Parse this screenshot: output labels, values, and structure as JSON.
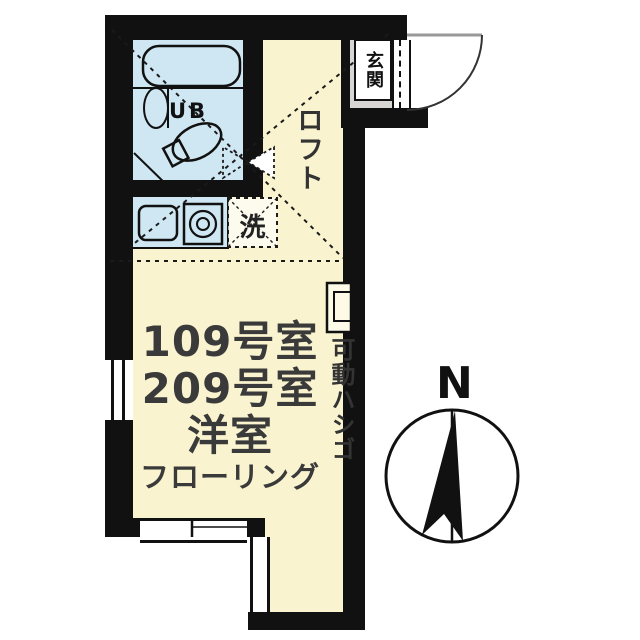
{
  "plan": {
    "type": "apartment-floor-plan",
    "labels": {
      "entrance": "玄関",
      "loft": "ロフト",
      "unit_bath": "UB",
      "laundry_space": "洗",
      "movable_ladder": "可動ハシゴ",
      "compass_north": "N"
    },
    "room_info": {
      "line1": "109号室",
      "line2": "209号室",
      "line3": "洋室",
      "line4": "フローリング"
    },
    "icons": [
      "bathtub-icon",
      "toilet-icon",
      "washbasin-icon",
      "kitchen-sink-icon",
      "stove-burner-icon",
      "ladder-icon",
      "door-swing-icon",
      "compass-icon",
      "window-symbol",
      "loft-extent-dashed-lines"
    ],
    "colors": {
      "wall": "#111111",
      "wet_area_fill": "#cfe7f3",
      "flooring_fill": "#f9f4cf",
      "entrance_floor": "#d8d6d3",
      "text": "#333333",
      "background": "#ffffff"
    }
  }
}
